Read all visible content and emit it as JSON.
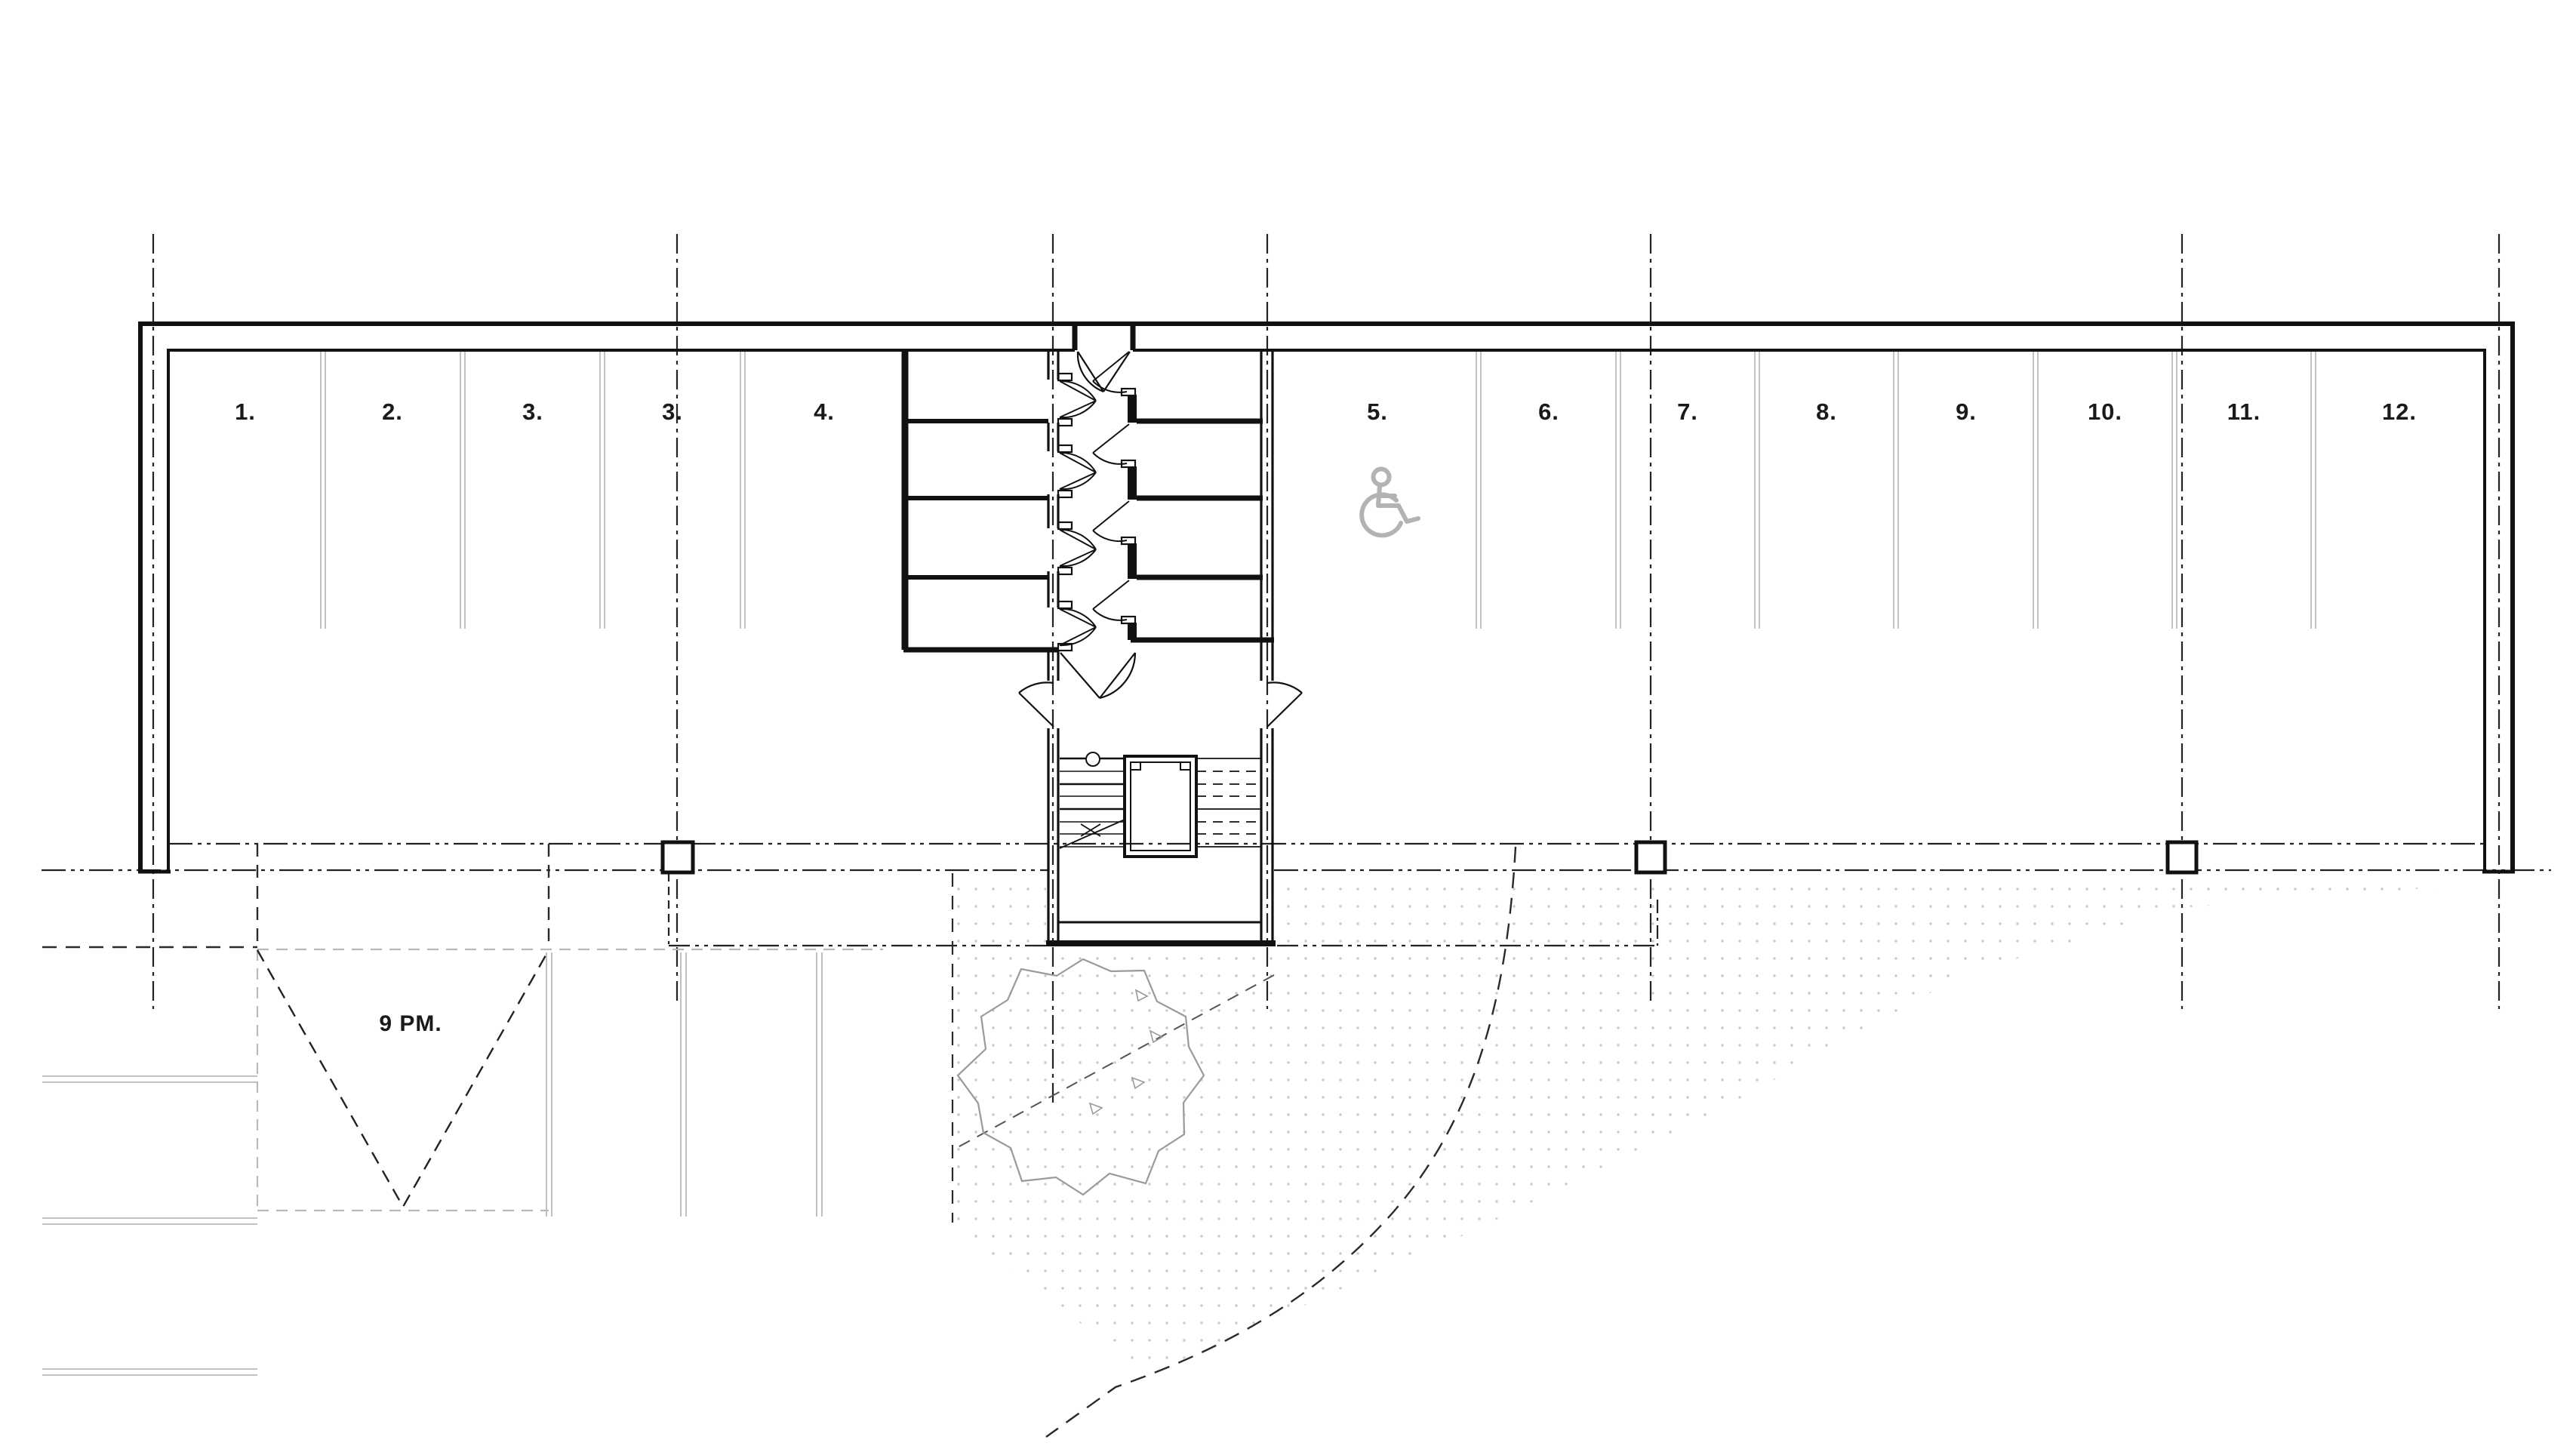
{
  "drawing": {
    "kind": "parking-garage-floor-plan",
    "parking": {
      "space_labels": [
        "1.",
        "2.",
        "3.",
        "3.",
        "4.",
        "5.",
        "6.",
        "7.",
        "8.",
        "9.",
        "10.",
        "11.",
        "12."
      ]
    },
    "site": {
      "shadow_label": "9 PM."
    },
    "icons": {
      "accessible_parking": "wheelchair-icon",
      "tree": "tree-canopy",
      "stairs": "stair-flight",
      "grid": "centerline-grid"
    },
    "colors": {
      "ink": "#1a1a1a",
      "muted_gray": "#b9b9b9",
      "tree_gray": "#9a9a9a",
      "dot_gray": "#c9c9c9"
    }
  }
}
